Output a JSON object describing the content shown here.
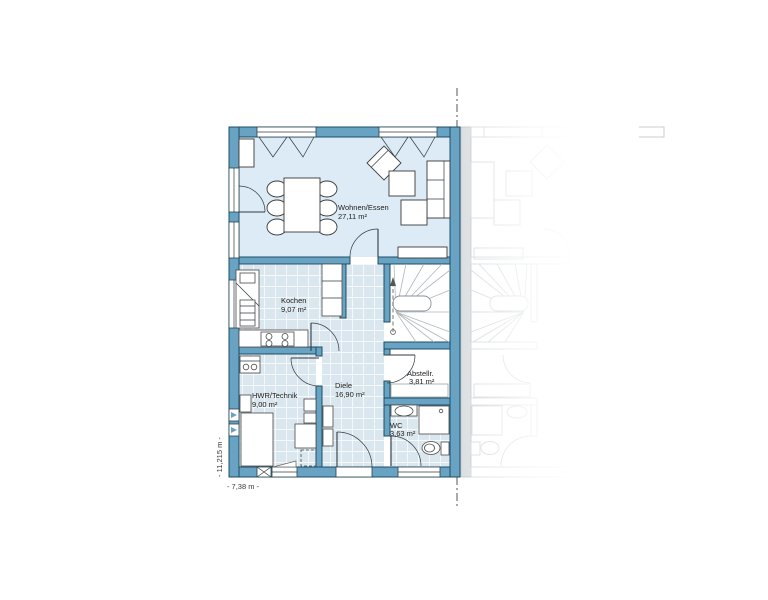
{
  "plan": {
    "rooms": [
      {
        "name": "Wohnen/Essen",
        "area": "27,11 m²"
      },
      {
        "name": "Kochen",
        "area": "9,07 m²"
      },
      {
        "name": "Diele",
        "area": "16,90 m²"
      },
      {
        "name": "Abstellr.",
        "area": "3,81 m²"
      },
      {
        "name": "HWR/Technik",
        "area": "9,00 m²"
      },
      {
        "name": "WC",
        "area": "3,63 m²"
      }
    ],
    "dimensions": {
      "total_height": "- 11,215 m -",
      "total_width": "- 7,38 m -"
    },
    "colors": {
      "wall_fill": "#68a3c4",
      "wall_outline": "#1e4d66",
      "living_floor": "#dcebf5",
      "tile_floor": "#dbe7ee",
      "neighbor_line": "#c3c9ce",
      "boundary_line": "#555555"
    }
  }
}
